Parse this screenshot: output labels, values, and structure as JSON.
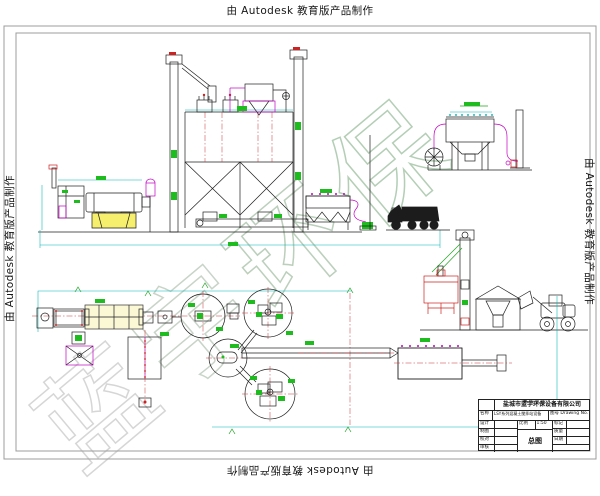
{
  "watermarks": {
    "autodesk_top": "由 Autodesk 教育版产品制作",
    "autodesk_bottom": "由 Autodesk 教育版产品制作",
    "autodesk_left": "由 Autodesk 教育版产品制作",
    "autodesk_right": "由 Autodesk 教育版产品制作",
    "brand_chars": [
      "蓝",
      "宇",
      "环",
      "保"
    ]
  },
  "title_block": {
    "company": "盐城市蓝宇环保设备有限公司",
    "name_label": "名称",
    "name_value": "LSY系列混凝土搅拌站设备",
    "drawing_no_label": "图号 Drawing No.",
    "drawing_title": "总图",
    "scale_label": "比例",
    "scale_value": "1:50",
    "left_rows": [
      {
        "label": "设计"
      },
      {
        "label": "制图"
      },
      {
        "label": "校对"
      },
      {
        "label": "审核"
      }
    ],
    "right_rows": [
      {
        "label": "标记"
      },
      {
        "label": "质量"
      },
      {
        "label": "日期"
      }
    ],
    "sheet_label": "共 张 第 张"
  },
  "colors": {
    "line": "#1f1f1f",
    "magenta": "#c400c4",
    "cyan": "#00b3b3",
    "green": "#1fbc1f",
    "red": "#cc2222",
    "yellow_fill": "#f6ef6d",
    "watermark_green": "#b4ceb6",
    "watermark_gray": "#d6d6d6"
  }
}
